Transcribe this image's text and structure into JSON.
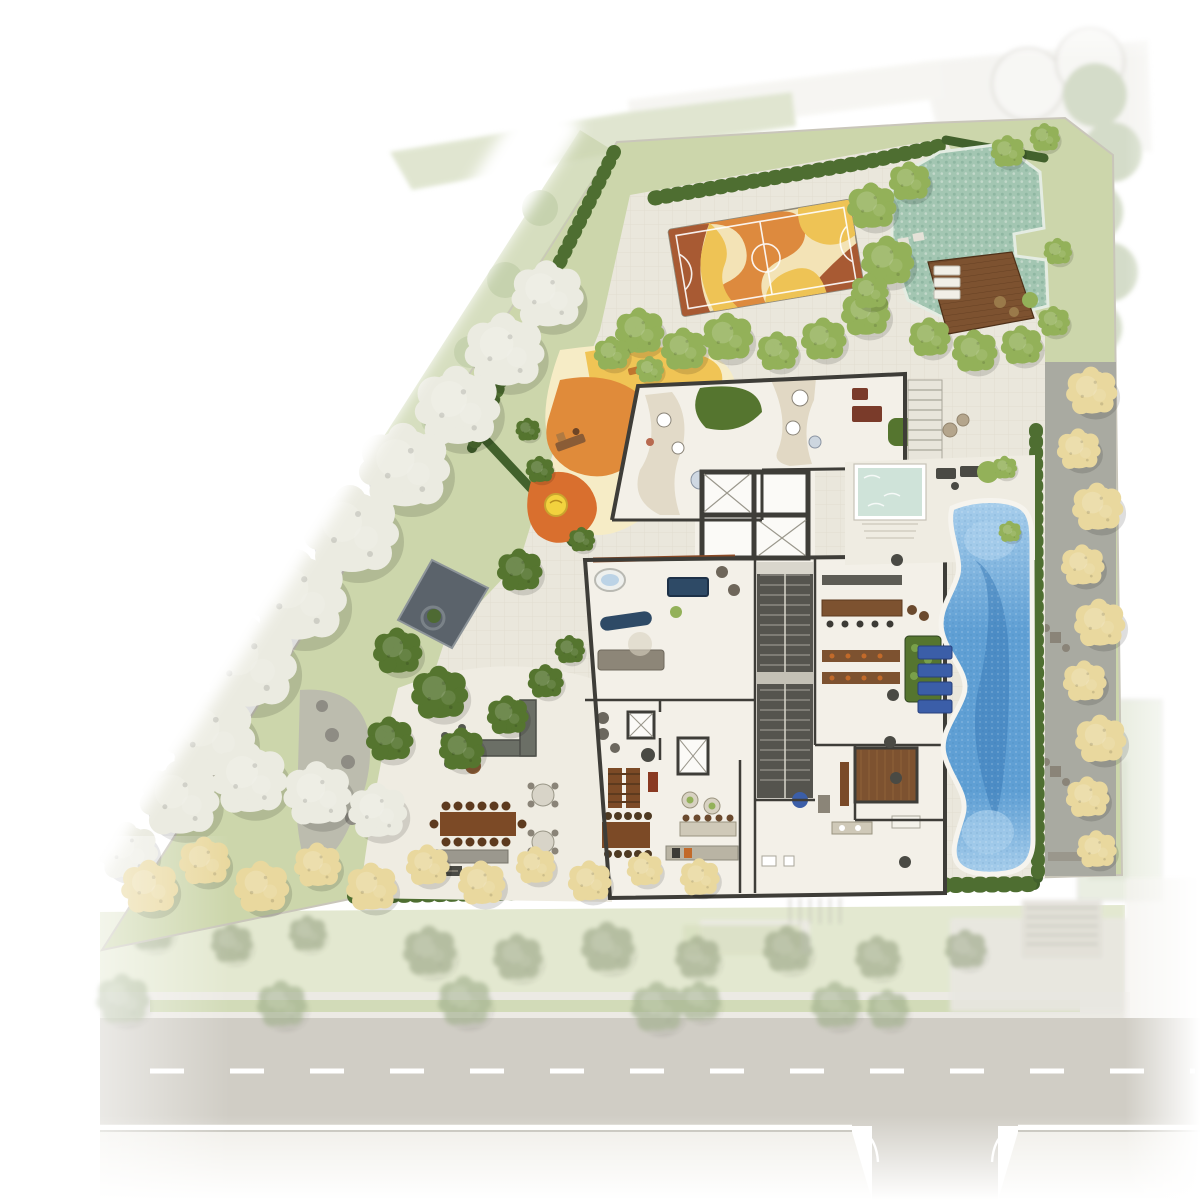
{
  "meta": {
    "description": "Illustrated architectural site plan of a residential ground floor with gardens, sports court, pools, terrace and street"
  },
  "palette": {
    "page": "#ffffff",
    "site_grass": "#ccd6ab",
    "grass_light": "#dde4c6",
    "walkway_green": "#ccd6b0",
    "paving": "#eae7dc",
    "paving_line": "#d8d4c6",
    "deck_paving": "#efece2",
    "floor": "#f3f0e8",
    "room_white": "#fbfaf7",
    "wall": "#3e3d38",
    "ramp": "#55544e",
    "court_base": "#f3e3b6",
    "court_gold": "#eec355",
    "court_orange": "#dd8a3e",
    "court_rust": "#a85a33",
    "court_line": "#ffffff",
    "natural_pool": "#a3c6b2",
    "pebble_dark": "#8fb7a2",
    "pebble_light": "#c2d8ca",
    "deck_wood": "#7d5230",
    "plank": "#5d3a1e",
    "spa_pool": "#cfe3d9",
    "pool_light": "#a9cfec",
    "pool_mid": "#5f9fd4",
    "pool_deep": "#3a7ab5",
    "pool_rim": "#f6f4ee",
    "hedge": "#42612c",
    "hedge_light": "#4e6e31",
    "tree_green": "#93b159",
    "tree_dark": "#55752f",
    "tree_white": "#ebebe1",
    "tree_yellow": "#e9d89e",
    "tree_palm": "#9aa585",
    "tree_street": "#9fae8a",
    "pond": "#5b636b",
    "pond_rim": "#8d9499",
    "path_gray": "#b9b7ae",
    "stone": "#8e8c84",
    "street_asphalt": "#c6c3b9",
    "sidewalk": "#eceae2",
    "sidewalk_top": "#e8e6df",
    "grass_strip": "#c9d4a9",
    "lane": "#ffffff",
    "curb": "#b3b0a6",
    "alley": "#a6a6a0",
    "neighbor": "#efeee9",
    "neighbor_stroke": "#d5d3cc",
    "furn_dark": "#4a4a44",
    "furn_navy": "#2e4a66",
    "lounger_blue": "#3b5ea8",
    "furn_wood": "#7c4a26",
    "furn_red": "#7a3b2a",
    "bench_blue": "#4f7fc4",
    "playground_gold": "#f0c455",
    "playground_orange": "#e08b3a",
    "playground_deep": "#d96f2e",
    "playground_sand": "#f6ecc6",
    "disc_yellow": "#f2d23e"
  },
  "street": {
    "lane_dash": "34 46"
  },
  "icons": {
    "tree": "fluffy-tree-symbol"
  },
  "vegetation": [
    {
      "x": 640,
      "y": 332,
      "r": 26,
      "type": "green"
    },
    {
      "x": 684,
      "y": 350,
      "r": 24,
      "type": "green"
    },
    {
      "x": 728,
      "y": 338,
      "r": 27,
      "type": "green"
    },
    {
      "x": 778,
      "y": 352,
      "r": 22,
      "type": "green"
    },
    {
      "x": 824,
      "y": 340,
      "r": 24,
      "type": "green"
    },
    {
      "x": 866,
      "y": 314,
      "r": 26,
      "type": "green"
    },
    {
      "x": 888,
      "y": 262,
      "r": 28,
      "type": "green"
    },
    {
      "x": 872,
      "y": 207,
      "r": 26,
      "type": "green"
    },
    {
      "x": 910,
      "y": 182,
      "r": 22,
      "type": "green"
    },
    {
      "x": 1008,
      "y": 152,
      "r": 18,
      "type": "green"
    },
    {
      "x": 1045,
      "y": 138,
      "r": 16,
      "type": "green"
    },
    {
      "x": 870,
      "y": 292,
      "r": 20,
      "type": "green"
    },
    {
      "x": 930,
      "y": 338,
      "r": 22,
      "type": "green"
    },
    {
      "x": 975,
      "y": 352,
      "r": 24,
      "type": "green"
    },
    {
      "x": 1022,
      "y": 346,
      "r": 22,
      "type": "green"
    },
    {
      "x": 1054,
      "y": 322,
      "r": 17,
      "type": "green"
    },
    {
      "x": 1058,
      "y": 252,
      "r": 15,
      "type": "green"
    },
    {
      "x": 612,
      "y": 354,
      "r": 19,
      "type": "green"
    },
    {
      "x": 650,
      "y": 370,
      "r": 15,
      "type": "green"
    },
    {
      "x": 1005,
      "y": 468,
      "r": 13,
      "type": "green"
    },
    {
      "x": 1010,
      "y": 532,
      "r": 12,
      "type": "green"
    },
    {
      "x": 398,
      "y": 652,
      "r": 26,
      "type": "dark"
    },
    {
      "x": 440,
      "y": 694,
      "r": 30,
      "type": "dark"
    },
    {
      "x": 390,
      "y": 740,
      "r": 25,
      "type": "dark"
    },
    {
      "x": 462,
      "y": 750,
      "r": 24,
      "type": "dark"
    },
    {
      "x": 508,
      "y": 716,
      "r": 22,
      "type": "dark"
    },
    {
      "x": 546,
      "y": 682,
      "r": 19,
      "type": "dark"
    },
    {
      "x": 570,
      "y": 650,
      "r": 16,
      "type": "dark"
    },
    {
      "x": 520,
      "y": 571,
      "r": 24,
      "type": "dark"
    },
    {
      "x": 582,
      "y": 540,
      "r": 14,
      "type": "dark"
    },
    {
      "x": 540,
      "y": 470,
      "r": 15,
      "type": "dark"
    },
    {
      "x": 528,
      "y": 430,
      "r": 13,
      "type": "dark"
    },
    {
      "x": 548,
      "y": 296,
      "r": 38,
      "type": "white"
    },
    {
      "x": 505,
      "y": 352,
      "r": 42,
      "type": "white"
    },
    {
      "x": 458,
      "y": 408,
      "r": 45,
      "type": "white"
    },
    {
      "x": 405,
      "y": 468,
      "r": 48,
      "type": "white"
    },
    {
      "x": 352,
      "y": 532,
      "r": 50,
      "type": "white"
    },
    {
      "x": 298,
      "y": 598,
      "r": 52,
      "type": "white"
    },
    {
      "x": 248,
      "y": 665,
      "r": 52,
      "type": "white"
    },
    {
      "x": 210,
      "y": 737,
      "r": 48,
      "type": "white"
    },
    {
      "x": 180,
      "y": 800,
      "r": 42,
      "type": "white"
    },
    {
      "x": 250,
      "y": 780,
      "r": 40,
      "type": "white"
    },
    {
      "x": 318,
      "y": 795,
      "r": 36,
      "type": "white"
    },
    {
      "x": 378,
      "y": 812,
      "r": 31,
      "type": "white"
    },
    {
      "x": 128,
      "y": 852,
      "r": 32,
      "type": "white"
    },
    {
      "x": 150,
      "y": 888,
      "r": 30,
      "type": "yellow"
    },
    {
      "x": 205,
      "y": 862,
      "r": 27,
      "type": "yellow"
    },
    {
      "x": 262,
      "y": 888,
      "r": 29,
      "type": "yellow"
    },
    {
      "x": 318,
      "y": 866,
      "r": 25,
      "type": "yellow"
    },
    {
      "x": 372,
      "y": 888,
      "r": 27,
      "type": "yellow"
    },
    {
      "x": 428,
      "y": 866,
      "r": 23,
      "type": "yellow"
    },
    {
      "x": 482,
      "y": 884,
      "r": 25,
      "type": "yellow"
    },
    {
      "x": 536,
      "y": 866,
      "r": 21,
      "type": "yellow"
    },
    {
      "x": 590,
      "y": 882,
      "r": 23,
      "type": "yellow"
    },
    {
      "x": 645,
      "y": 870,
      "r": 19,
      "type": "yellow"
    },
    {
      "x": 700,
      "y": 878,
      "r": 21,
      "type": "yellow"
    },
    {
      "x": 1092,
      "y": 392,
      "r": 27,
      "type": "yellow"
    },
    {
      "x": 1079,
      "y": 450,
      "r": 23,
      "type": "yellow"
    },
    {
      "x": 1098,
      "y": 508,
      "r": 27,
      "type": "yellow"
    },
    {
      "x": 1083,
      "y": 566,
      "r": 23,
      "type": "yellow"
    },
    {
      "x": 1100,
      "y": 624,
      "r": 27,
      "type": "yellow"
    },
    {
      "x": 1085,
      "y": 682,
      "r": 23,
      "type": "yellow"
    },
    {
      "x": 1101,
      "y": 740,
      "r": 27,
      "type": "yellow"
    },
    {
      "x": 1088,
      "y": 798,
      "r": 23,
      "type": "yellow"
    },
    {
      "x": 1097,
      "y": 850,
      "r": 21,
      "type": "yellow"
    },
    {
      "x": 430,
      "y": 952,
      "r": 28,
      "type": "palm"
    },
    {
      "x": 518,
      "y": 958,
      "r": 26,
      "type": "palm"
    },
    {
      "x": 608,
      "y": 948,
      "r": 28,
      "type": "palm"
    },
    {
      "x": 698,
      "y": 958,
      "r": 24,
      "type": "palm"
    },
    {
      "x": 788,
      "y": 950,
      "r": 26,
      "type": "palm"
    },
    {
      "x": 878,
      "y": 958,
      "r": 24,
      "type": "palm"
    },
    {
      "x": 966,
      "y": 950,
      "r": 22,
      "type": "palm"
    },
    {
      "x": 152,
      "y": 930,
      "r": 24,
      "type": "palm"
    },
    {
      "x": 232,
      "y": 944,
      "r": 22,
      "type": "palm"
    },
    {
      "x": 308,
      "y": 934,
      "r": 20,
      "type": "palm"
    },
    {
      "x": 123,
      "y": 1000,
      "r": 28,
      "type": "street"
    },
    {
      "x": 282,
      "y": 1005,
      "r": 26,
      "type": "street"
    },
    {
      "x": 465,
      "y": 1002,
      "r": 28,
      "type": "street"
    },
    {
      "x": 658,
      "y": 1008,
      "r": 28,
      "type": "street"
    },
    {
      "x": 700,
      "y": 1002,
      "r": 22,
      "type": "street"
    },
    {
      "x": 836,
      "y": 1006,
      "r": 26,
      "type": "street"
    },
    {
      "x": 888,
      "y": 1010,
      "r": 22,
      "type": "street"
    }
  ]
}
